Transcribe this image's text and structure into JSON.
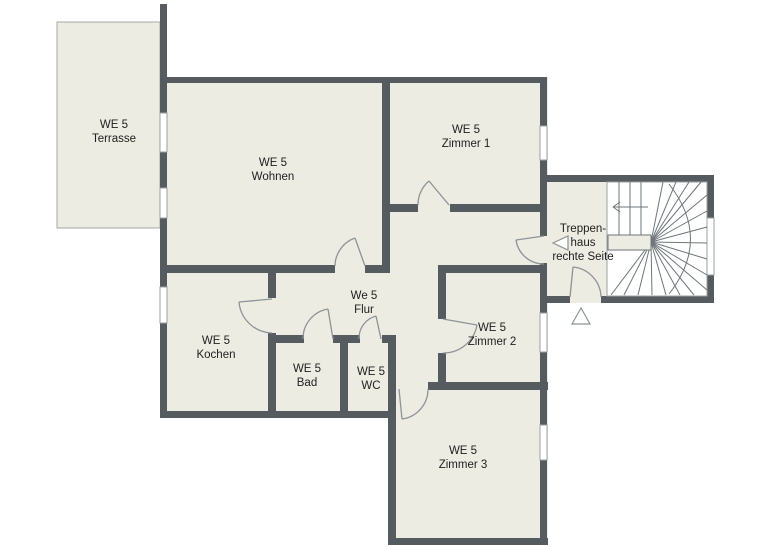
{
  "rooms": {
    "terrasse": {
      "l1": "WE 5",
      "l2": "Terrasse"
    },
    "wohnen": {
      "l1": "WE 5",
      "l2": "Wohnen"
    },
    "zimmer1": {
      "l1": "WE 5",
      "l2": "Zimmer 1"
    },
    "flur": {
      "l1": "We 5",
      "l2": "Flur"
    },
    "kochen": {
      "l1": "WE 5",
      "l2": "Kochen"
    },
    "bad": {
      "l1": "WE 5",
      "l2": "Bad"
    },
    "wc": {
      "l1": "WE 5",
      "l2": "WC"
    },
    "zimmer2": {
      "l1": "WE 5",
      "l2": "Zimmer 2"
    },
    "zimmer3": {
      "l1": "WE 5",
      "l2": "Zimmer 3"
    },
    "treppenhaus": {
      "l1": "Treppen-",
      "l2": "haus",
      "l3": "rechte Seite"
    }
  },
  "icons": {
    "stair_direction_arrow": "left-arrow",
    "entrance_marker": "left-triangle",
    "exit_marker": "up-triangle"
  },
  "colors": {
    "wall": "#565b60",
    "room_fill": "#edece3",
    "background": "#ffffff",
    "thin_line": "#9aa0a3",
    "door_line": "#8d9397",
    "stair_line": "#6f767b",
    "text": "#1e1e1e",
    "terrace_border": "#a6a9a4"
  }
}
